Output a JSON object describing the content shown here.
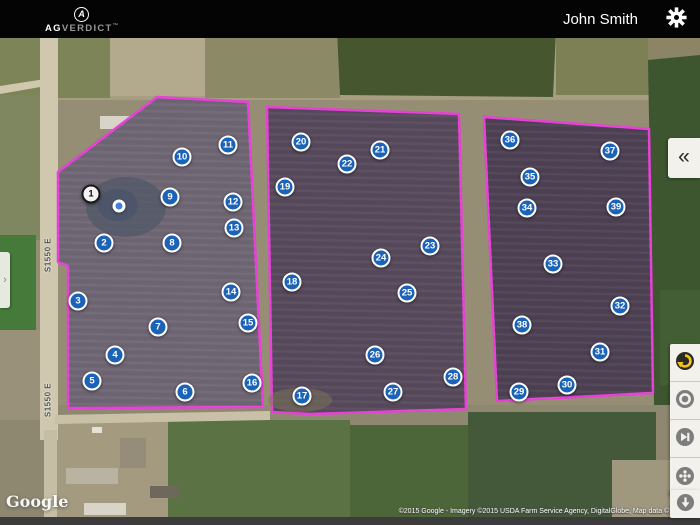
{
  "header": {
    "brand": {
      "icon_letter": "A",
      "name_bold": "AG",
      "name_rest": "VERDICT",
      "tm": "™"
    },
    "user_name": "John Smith",
    "settings_icon": "gear-icon"
  },
  "left_panel": {
    "expand_icon": "›"
  },
  "right_panel": {
    "collapse_icon": "«",
    "tools": [
      {
        "icon": "sync-circle-icon",
        "accent": "#f2c41d"
      },
      {
        "icon": "record-donut-icon",
        "accent": "#7d7d7d"
      },
      {
        "icon": "skip-forward-icon",
        "accent": "#7d7d7d"
      },
      {
        "icon": "reel-dots-icon",
        "accent": "#7d7d7d"
      }
    ],
    "download_icon": "download-arrow-icon"
  },
  "map": {
    "google_logo": "Google",
    "attribution": "©2015 Google - Imagery ©2015 USDA Farm Service Agency, DigitalGlobe, Map data ©20",
    "road_labels": [
      {
        "text": "S1550 E",
        "x": 48,
        "y": 255
      },
      {
        "text": "S1550 E",
        "x": 48,
        "y": 400
      }
    ],
    "location_dot": {
      "x": 119,
      "y": 206
    },
    "markers": [
      {
        "n": 1,
        "x": 91,
        "y": 194,
        "selected": true
      },
      {
        "n": 2,
        "x": 104,
        "y": 243
      },
      {
        "n": 3,
        "x": 78,
        "y": 301
      },
      {
        "n": 4,
        "x": 115,
        "y": 355
      },
      {
        "n": 5,
        "x": 92,
        "y": 381
      },
      {
        "n": 6,
        "x": 185,
        "y": 392
      },
      {
        "n": 7,
        "x": 158,
        "y": 327
      },
      {
        "n": 8,
        "x": 172,
        "y": 243
      },
      {
        "n": 9,
        "x": 170,
        "y": 197
      },
      {
        "n": 10,
        "x": 182,
        "y": 157
      },
      {
        "n": 11,
        "x": 228,
        "y": 145
      },
      {
        "n": 12,
        "x": 233,
        "y": 202
      },
      {
        "n": 13,
        "x": 234,
        "y": 228
      },
      {
        "n": 14,
        "x": 231,
        "y": 292
      },
      {
        "n": 15,
        "x": 248,
        "y": 323
      },
      {
        "n": 16,
        "x": 252,
        "y": 383
      },
      {
        "n": 17,
        "x": 302,
        "y": 396
      },
      {
        "n": 18,
        "x": 292,
        "y": 282
      },
      {
        "n": 19,
        "x": 285,
        "y": 187
      },
      {
        "n": 20,
        "x": 301,
        "y": 142
      },
      {
        "n": 21,
        "x": 380,
        "y": 150
      },
      {
        "n": 22,
        "x": 347,
        "y": 164
      },
      {
        "n": 23,
        "x": 430,
        "y": 246
      },
      {
        "n": 24,
        "x": 381,
        "y": 258
      },
      {
        "n": 25,
        "x": 407,
        "y": 293
      },
      {
        "n": 26,
        "x": 375,
        "y": 355
      },
      {
        "n": 27,
        "x": 393,
        "y": 392
      },
      {
        "n": 28,
        "x": 453,
        "y": 377
      },
      {
        "n": 29,
        "x": 519,
        "y": 392
      },
      {
        "n": 30,
        "x": 567,
        "y": 385
      },
      {
        "n": 31,
        "x": 600,
        "y": 352
      },
      {
        "n": 32,
        "x": 620,
        "y": 306
      },
      {
        "n": 33,
        "x": 553,
        "y": 264
      },
      {
        "n": 34,
        "x": 527,
        "y": 208
      },
      {
        "n": 35,
        "x": 530,
        "y": 177
      },
      {
        "n": 36,
        "x": 510,
        "y": 140
      },
      {
        "n": 37,
        "x": 610,
        "y": 151
      },
      {
        "n": 38,
        "x": 522,
        "y": 325
      },
      {
        "n": 39,
        "x": 616,
        "y": 207
      }
    ]
  },
  "colors": {
    "marker_blue": "#1b63b7",
    "field_boundary_magenta": "#e83fd8",
    "topbar_black": "#040404",
    "button_face": "#f2f1ec",
    "tool_yellow": "#f2c41d"
  }
}
